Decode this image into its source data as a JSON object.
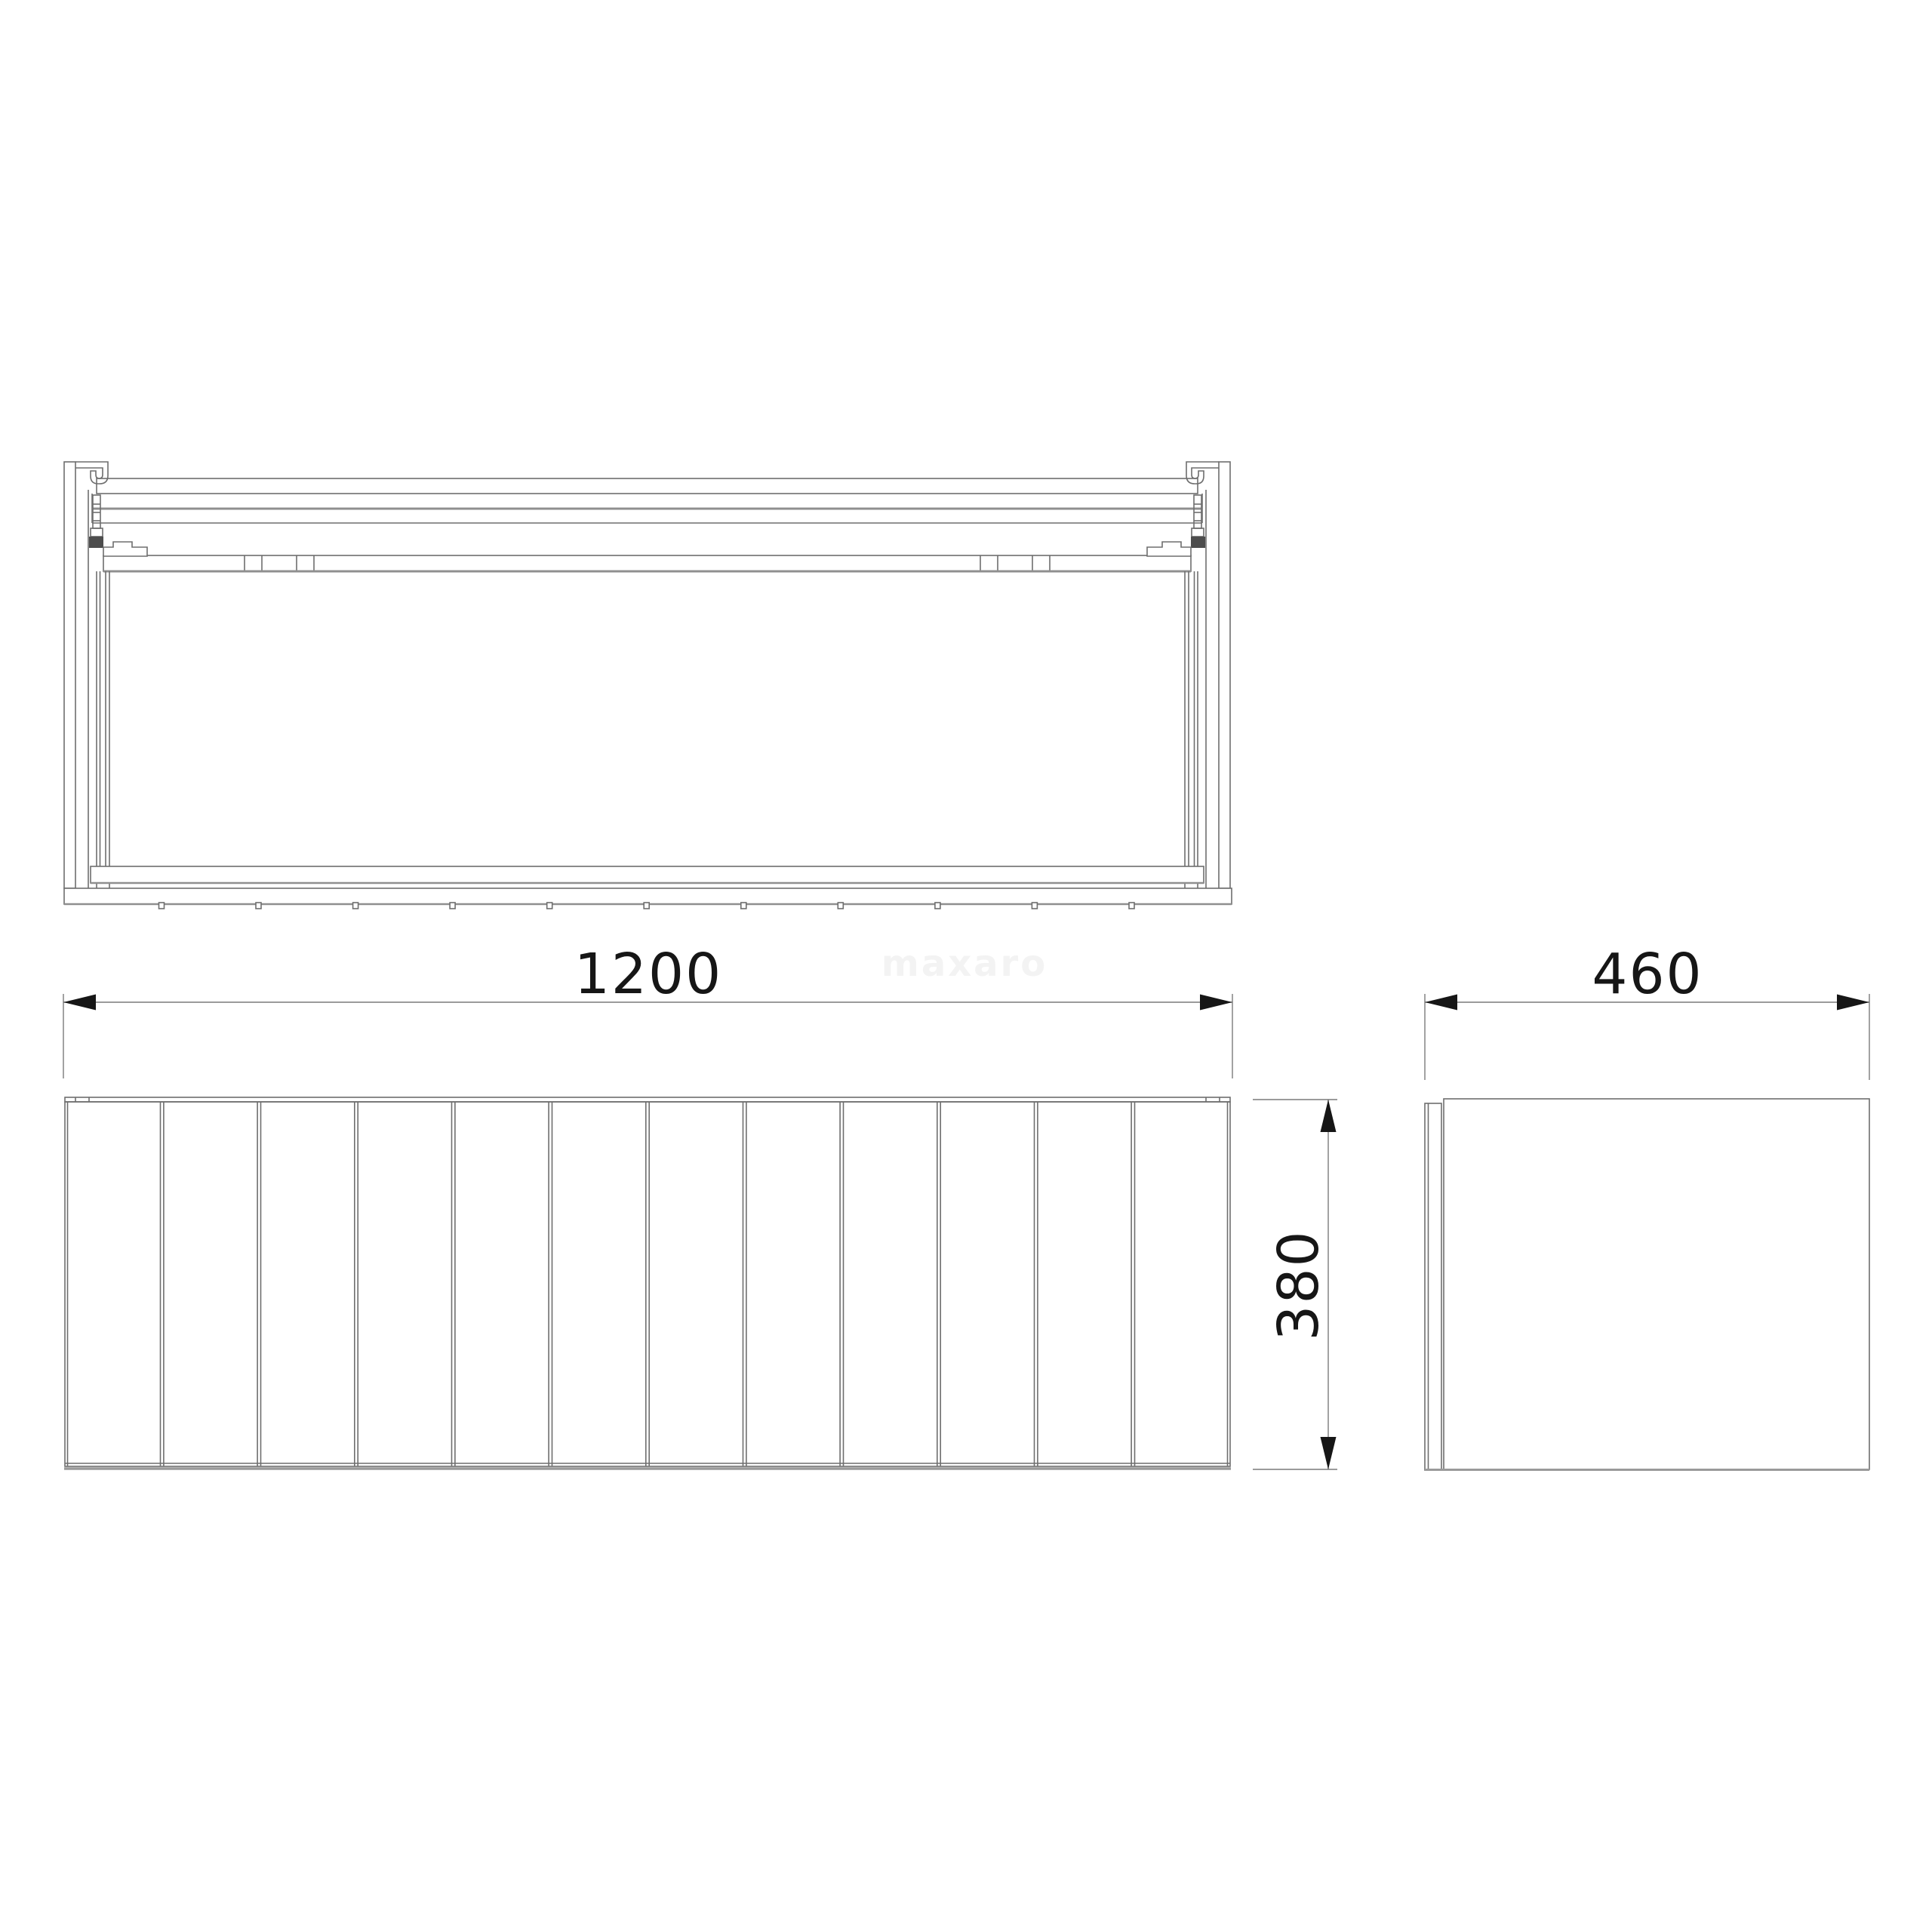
{
  "watermark": {
    "text": "maxaro",
    "color": "#f3f3f3"
  },
  "dimensions": {
    "width_mm": "1200",
    "depth_mm": "460",
    "height_mm": "380"
  },
  "views": {
    "top_view": {
      "description": "plan section of cabinet with drawer slides"
    },
    "front_view": {
      "slat_count": 12,
      "groove_count": 11
    },
    "side_view": {
      "panels": 2
    }
  },
  "colors": {
    "background": "#ffffff",
    "line_thin": "#6e6e6e",
    "line_thick": "#8f8f8f",
    "ink": "#161616",
    "clip_fill": "#4d4d4d"
  }
}
